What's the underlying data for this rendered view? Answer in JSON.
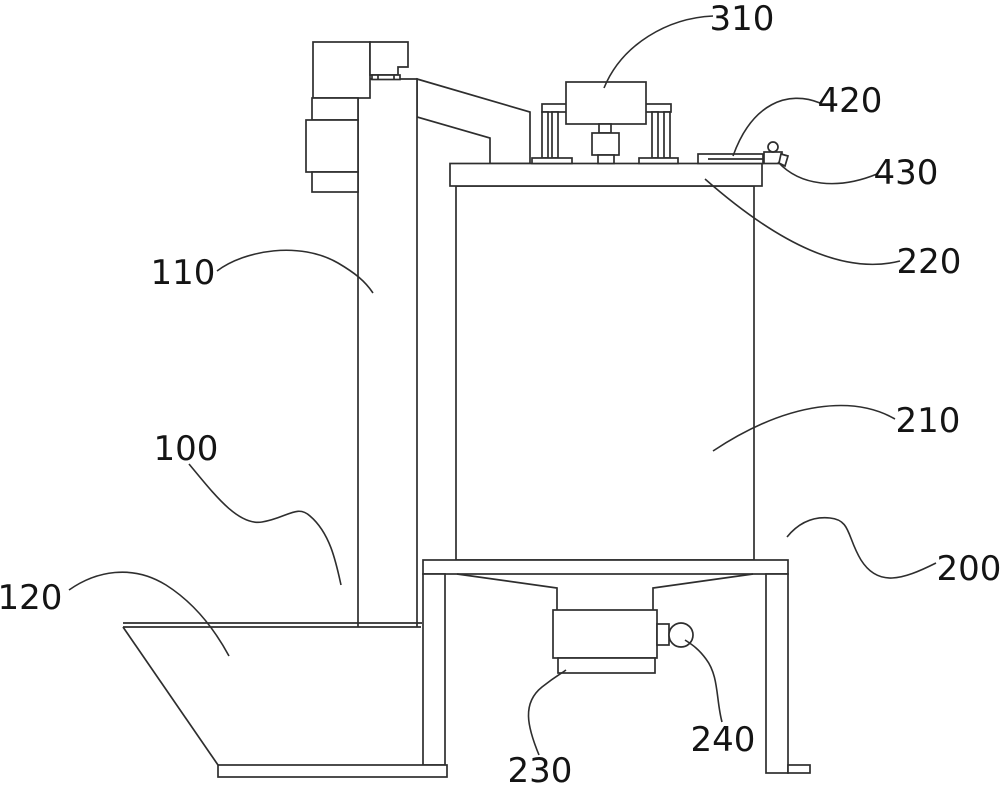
{
  "figure": {
    "title": "patent-style line drawing of mixing/feeding apparatus",
    "background_color": "#ffffff",
    "line_color": "#2e2e2e",
    "labels": {
      "l310": "310",
      "l420": "420",
      "l430": "430",
      "l220": "220",
      "l110": "110",
      "l210": "210",
      "l100": "100",
      "l120": "120",
      "l200": "200",
      "l230": "230",
      "l240": "240"
    }
  }
}
